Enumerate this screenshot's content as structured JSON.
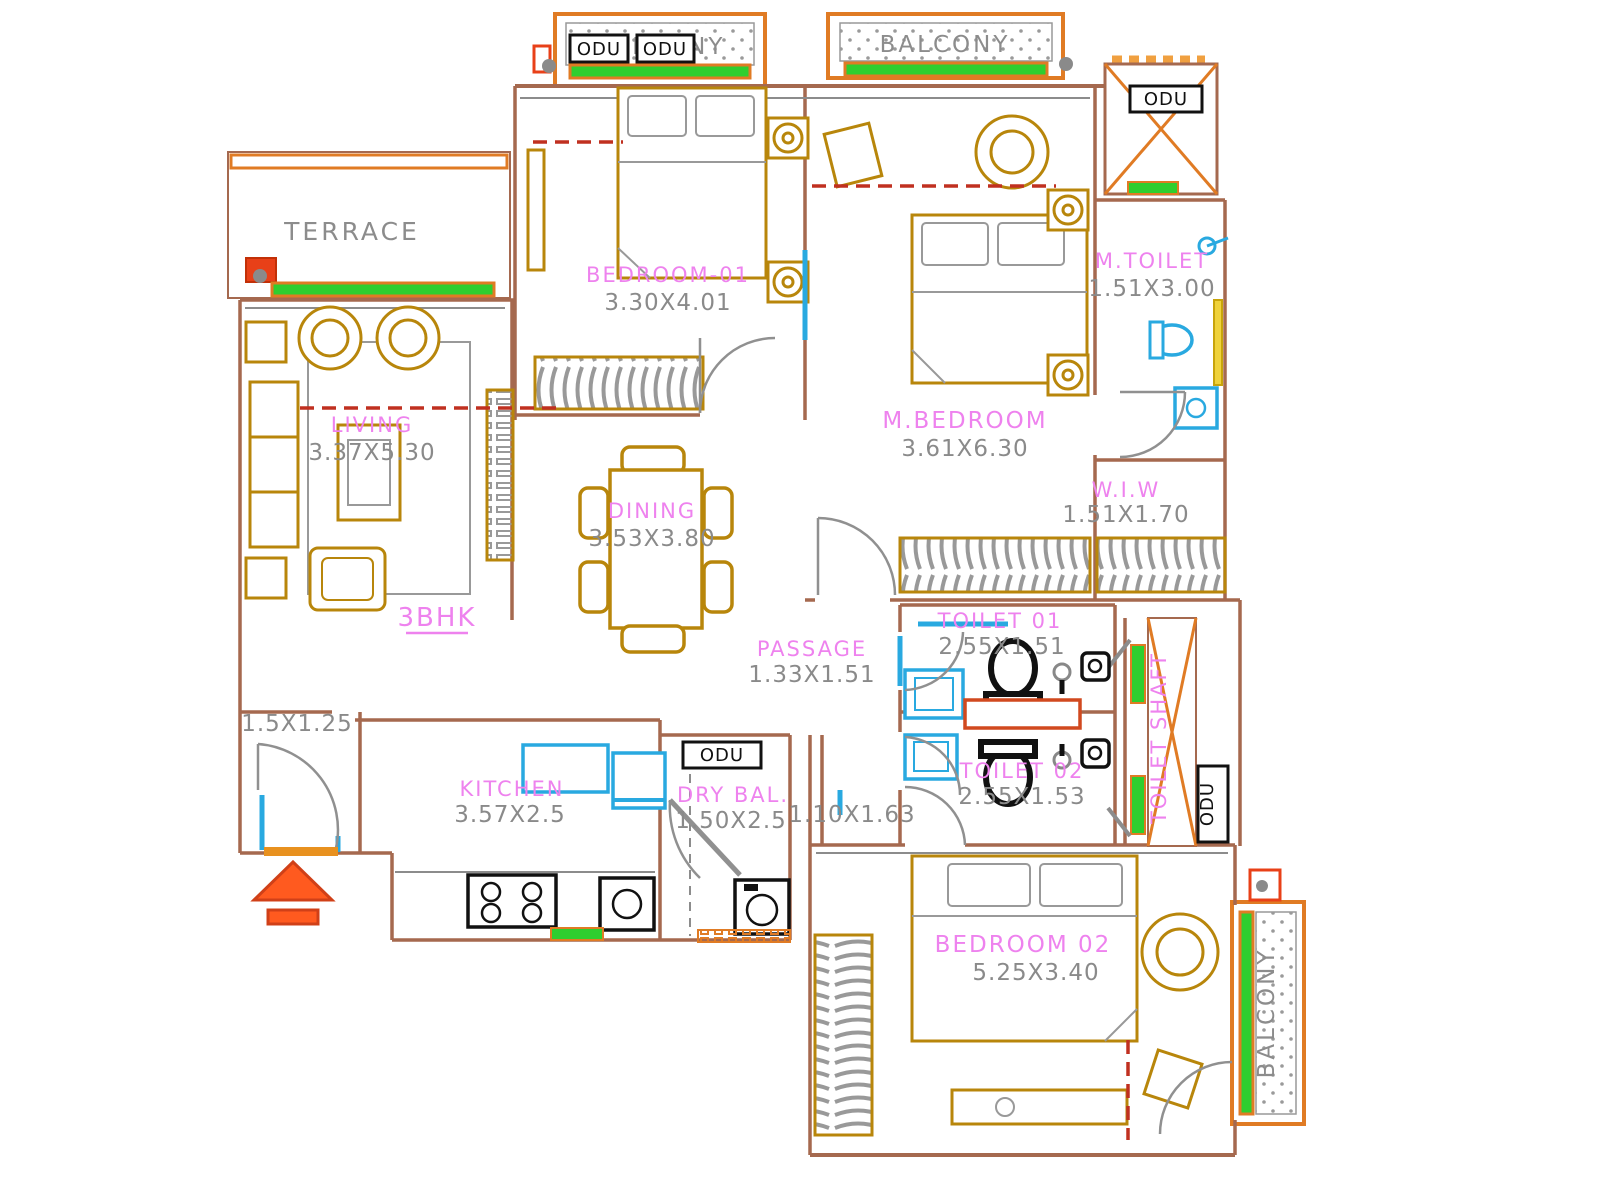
{
  "plan": {
    "type_label": "3BHK",
    "odu_label": "ODU",
    "rooms": {
      "terrace": {
        "name": "TERRACE",
        "dims": ""
      },
      "balcony_top_left": {
        "name": "BALCONY",
        "dims": ""
      },
      "balcony_top_right": {
        "name": "BALCONY",
        "dims": ""
      },
      "balcony_right": {
        "name": "BALCONY",
        "dims": ""
      },
      "bedroom_01": {
        "name": "BEDROOM-01",
        "dims": "3.30X4.01"
      },
      "m_bedroom": {
        "name": "M.BEDROOM",
        "dims": "3.61X6.30"
      },
      "m_toilet": {
        "name": "M.TOILET",
        "dims": "1.51X3.00"
      },
      "wiw": {
        "name": "W.I.W",
        "dims": "1.51X1.70"
      },
      "living": {
        "name": "LIVING",
        "dims": "3.37X5.30"
      },
      "dining": {
        "name": "DINING",
        "dims": "3.53X3.80"
      },
      "passage": {
        "name": "PASSAGE",
        "dims": "1.33X1.51"
      },
      "toilet_01": {
        "name": "TOILET 01",
        "dims": "2.55X1.51"
      },
      "toilet_02": {
        "name": "TOILET 02",
        "dims": "2.55X1.53"
      },
      "kitchen": {
        "name": "KITCHEN",
        "dims": "3.57X2.5"
      },
      "dry_balcony": {
        "name": "DRY BAL.",
        "dims": "1.50X2.5"
      },
      "bedroom_02": {
        "name": "BEDROOM 02",
        "dims": "5.25X3.40"
      },
      "toilet_shaft": {
        "name": "TOILET SHAFT",
        "dims": ""
      },
      "foyer": {
        "name": "",
        "dims": "1.5X1.25"
      },
      "lobby": {
        "name": "",
        "dims": "1.10X1.63"
      }
    },
    "colors": {
      "wall": "#A5694F",
      "furniture": "#B8860B",
      "fixture_cyan": "#29A9E0",
      "window_green": "#2FCE2F",
      "balcony_orange": "#E07B24",
      "accent_red": "#F04A18",
      "label_pink": "#EE82EE",
      "text_gray": "#8C8C8C"
    }
  }
}
